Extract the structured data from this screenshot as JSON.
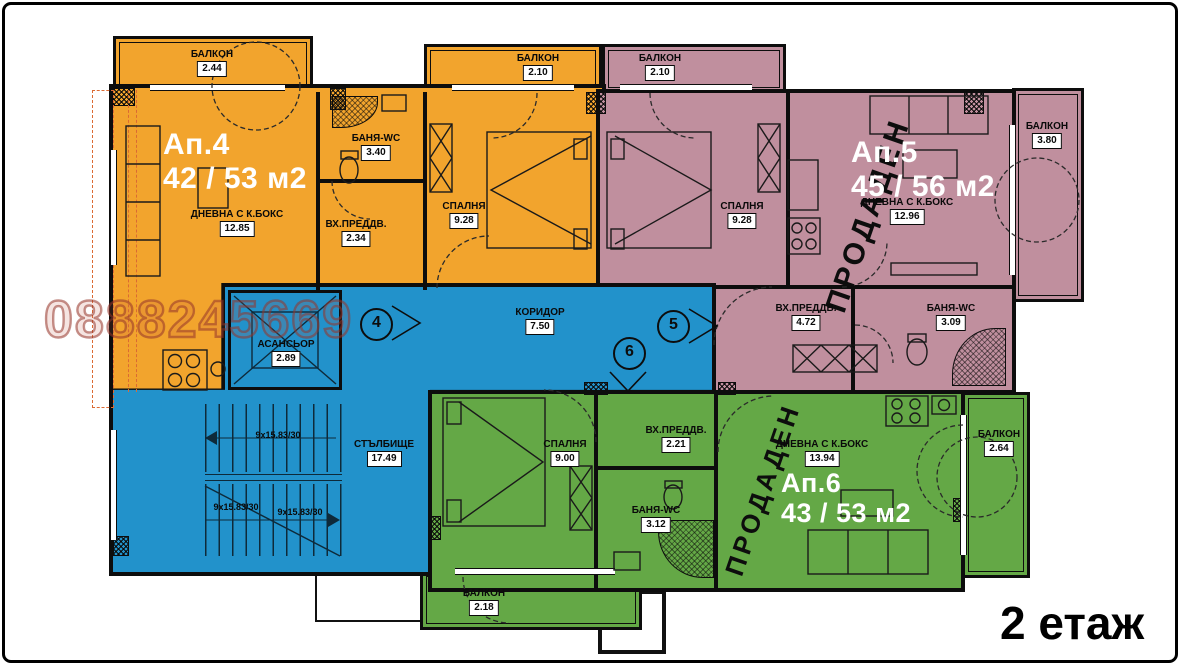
{
  "floor": {
    "label": "2 етаж"
  },
  "watermark": {
    "phone": "0888245669"
  },
  "colors": {
    "ap4": "#F2A42D",
    "ap5": "#C08F9E",
    "ap6": "#64A846",
    "common": "#2292CB",
    "watermark": "#96342A"
  },
  "apartments": {
    "ap4": {
      "name": "Ап.4",
      "area": "42 / 53 м2",
      "rooms": {
        "balcony_top_left": {
          "label": "БАЛКОН",
          "value": "2.44"
        },
        "balcony_top_right": {
          "label": "БАЛКОН",
          "value": "2.10"
        },
        "living": {
          "label": "ДНЕВНА С К.БОКС",
          "value": "12.85"
        },
        "bath": {
          "label": "БАНЯ-WC",
          "value": "3.40"
        },
        "entry": {
          "label": "ВХ.ПРЕДДВ.",
          "value": "2.34"
        },
        "bedroom": {
          "label": "СПАЛНЯ",
          "value": "9.28"
        }
      }
    },
    "ap5": {
      "name": "Ап.5",
      "area": "45 / 56 м2",
      "status": "ПРОДАДЕН",
      "rooms": {
        "balcony_top": {
          "label": "БАЛКОН",
          "value": "2.10"
        },
        "bedroom": {
          "label": "СПАЛНЯ",
          "value": "9.28"
        },
        "living": {
          "label": "ДНЕВНА С К.БОКС",
          "value": "12.96"
        },
        "entry": {
          "label": "ВХ.ПРЕДДВ.",
          "value": "4.72"
        },
        "bath": {
          "label": "БАНЯ-WC",
          "value": "3.09"
        },
        "balcony_right": {
          "label": "БАЛКОН",
          "value": "3.80"
        }
      }
    },
    "ap6": {
      "name": "Ап.6",
      "area": "43 / 53 м2",
      "status": "ПРОДАДЕН",
      "rooms": {
        "bedroom": {
          "label": "СПАЛНЯ",
          "value": "9.00"
        },
        "entry": {
          "label": "ВХ.ПРЕДДВ.",
          "value": "2.21"
        },
        "bath": {
          "label": "БАНЯ-WC",
          "value": "3.12"
        },
        "living": {
          "label": "ДНЕВНА С К.БОКС",
          "value": "13.94"
        },
        "balcony_right": {
          "label": "БАЛКОН",
          "value": "2.64"
        },
        "balcony_bottom": {
          "label": "БАЛКОН",
          "value": "2.18"
        }
      }
    }
  },
  "common": {
    "corridor": {
      "label": "КОРИДОР",
      "value": "7.50"
    },
    "elevator": {
      "label": "АСАНСЬОР",
      "value": "2.89"
    },
    "staircase": {
      "label": "СТЪЛБИЩЕ",
      "value": "17.49"
    },
    "stair_flight": "9x15.83/30",
    "markers": {
      "m4": "4",
      "m5": "5",
      "m6": "6"
    }
  }
}
